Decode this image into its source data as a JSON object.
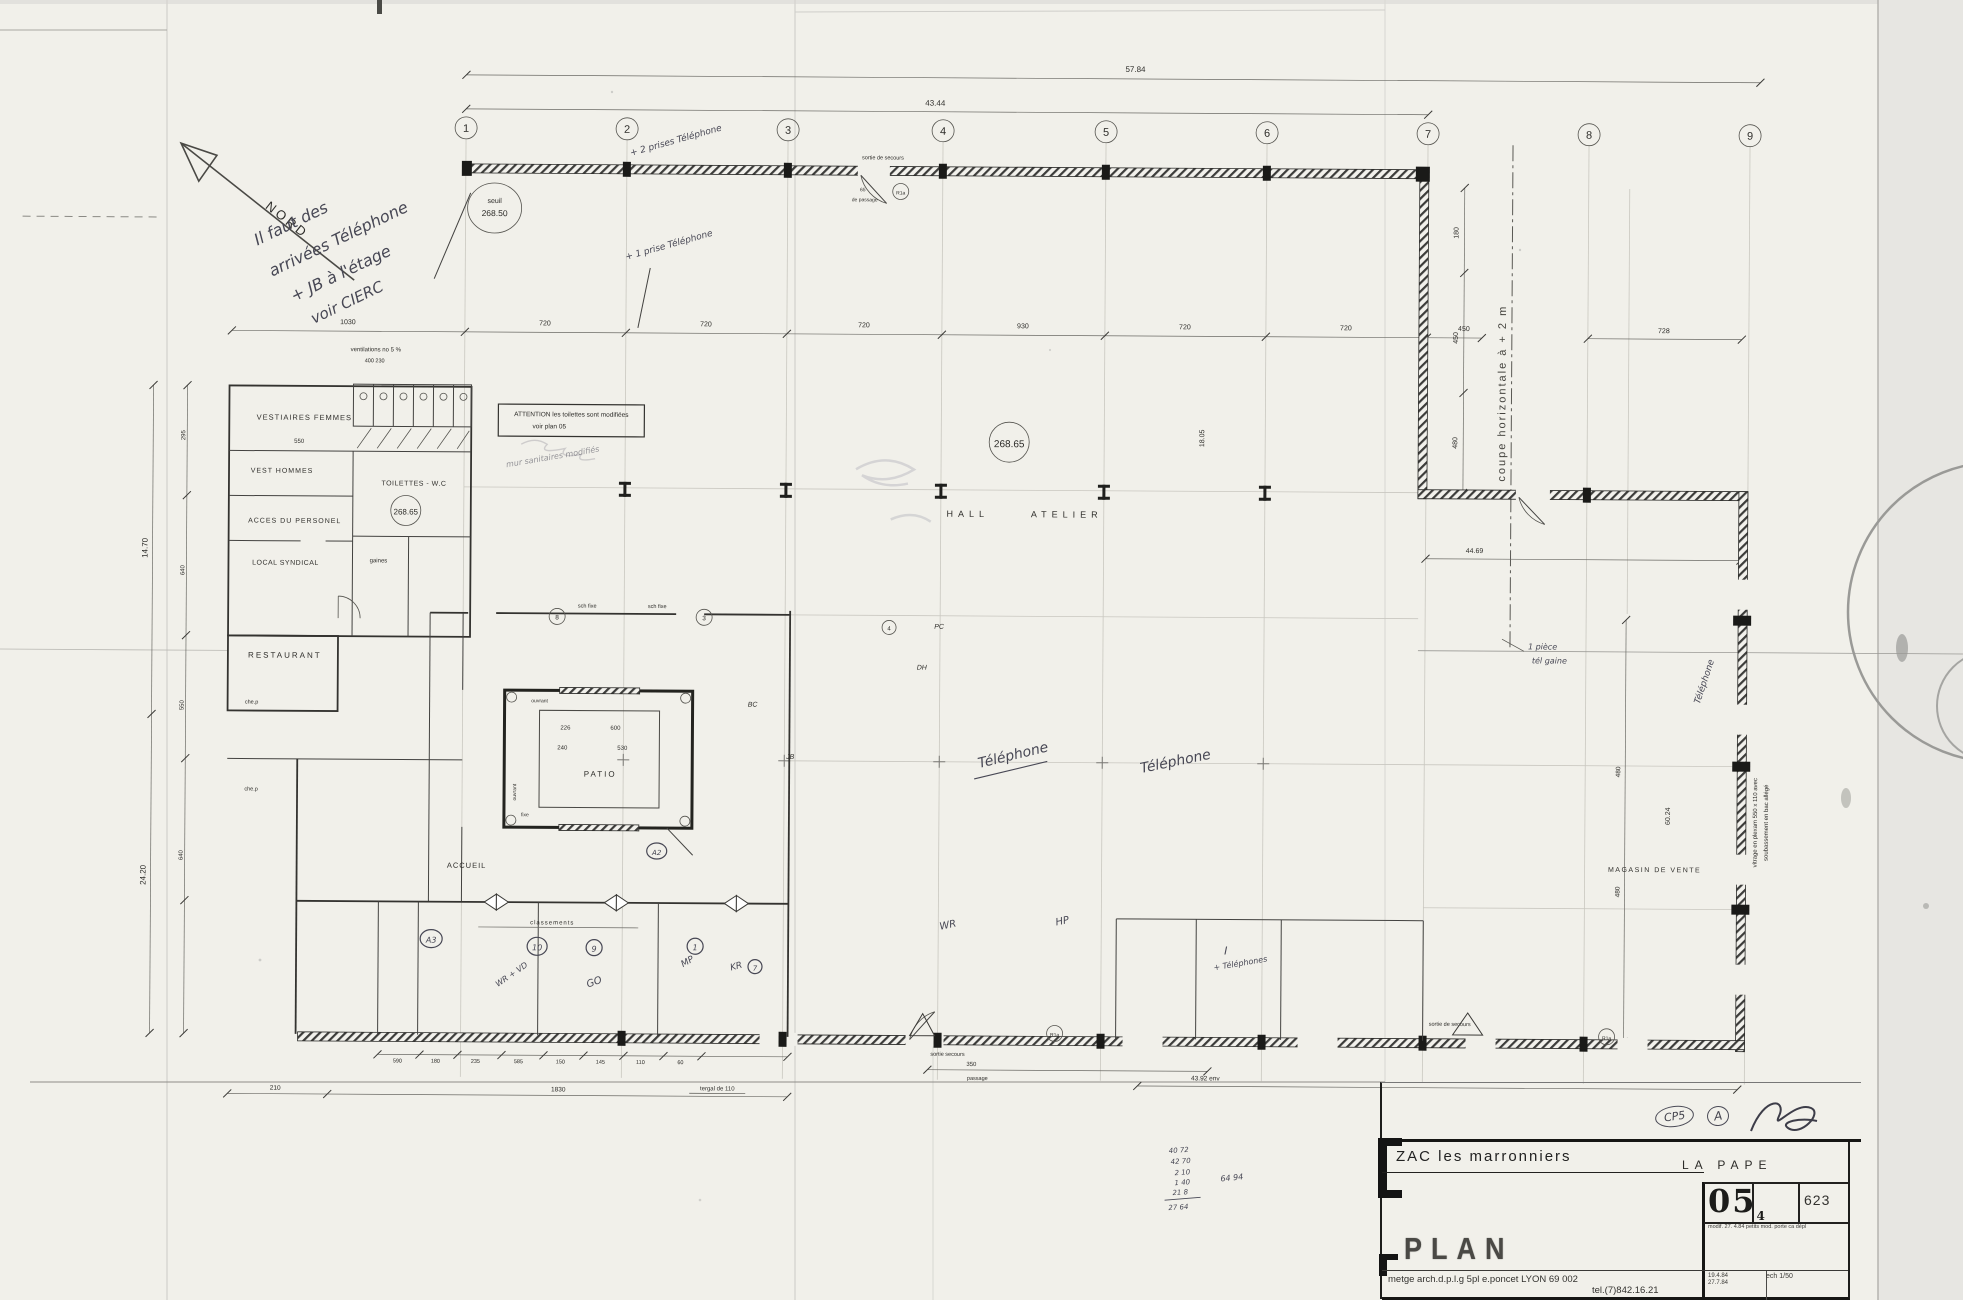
{
  "compass": {
    "label": "NORD"
  },
  "grid": {
    "bubbles": [
      "1",
      "2",
      "3",
      "4",
      "5",
      "6",
      "7",
      "8",
      "9"
    ]
  },
  "levels": {
    "seuil_line1": "seuil",
    "seuil_line2": "268.50",
    "hall": "268.65",
    "wc": "268.65"
  },
  "rooms": {
    "vestiaires": "VESTIAIRES  FEMMES",
    "vest_hommes": "VEST  HOMMES",
    "acces": "ACCES  DU  PERSONEL",
    "toilettes": "TOILETTES - W.C",
    "local_syndical": "LOCAL  SYNDICAL",
    "gaines": "gaines",
    "restaurant": "RESTAURANT",
    "hall_a": "HALL",
    "hall_b": "ATELIER",
    "patio": "PATIO",
    "accueil": "ACCUEIL",
    "magasin": "MAGASIN  DE  VENTE"
  },
  "attention": {
    "line1": "ATTENTION   les toilettes sont modifiées",
    "line2": "voir    plan 05"
  },
  "vent": {
    "line1": "ventilations no 5 %",
    "line2": "400    230"
  },
  "notes": {
    "tl1": "Il faut des",
    "tl2": "arrivées Téléphone",
    "tl3": "+ JB à l'étage",
    "tl4": "voir CIERC",
    "plus2": "+ 2 prises Téléphone",
    "plus1": "+ 1 prise Téléphone",
    "tel_a": "Téléphone",
    "tel_b": "Téléphone",
    "tel_c": "Téléphone",
    "piece": "1 pièce",
    "gaine": "tél gaine",
    "i_label": "I",
    "i_tel": "+ Téléphones",
    "wr": "WR",
    "hp": "HP",
    "scribble": "mur sanitaires modifiés",
    "wrvd": "WR + VD",
    "go": "GO",
    "mp": "MP",
    "kr": "KR"
  },
  "codes": {
    "a3": "A3",
    "n10": "10",
    "n9": "9",
    "n1": "1",
    "n7": "7",
    "a2": "A2",
    "c4": "4",
    "c8": "8",
    "c3": "3",
    "r1a_top": "R1a",
    "r1a_bottom": "R1a",
    "r1a_right": "R1a"
  },
  "marks": {
    "pc": "PC",
    "dh": "DH",
    "jb": "JB",
    "bc": "BC",
    "schfixe1": "sch fixe",
    "schfixe2": "sch fixe",
    "classements": "classements",
    "ouvrant1": "ouvrant",
    "ouvrant2": "ouvrant",
    "fixe": "fixe",
    "chep1": "che.p",
    "chep2": "che.p"
  },
  "sorties": {
    "top": "sortie de secours",
    "top_w": "65",
    "top_p": "de passage",
    "bottom": "sortie  secours",
    "bottom_d": "350",
    "bottom_p": "passage",
    "right": "sortie de secours"
  },
  "coupe": {
    "label": "coupe  horizontale  à  + 2 m"
  },
  "vitrage": {
    "line1": "vitrage en plexam  550 x 110 avec",
    "line2": "soubassement en bac allégé"
  },
  "dims": {
    "top1": "57.84",
    "top2": "43.44",
    "row": [
      "1030",
      "720",
      "720",
      "720",
      "930",
      "720",
      "720",
      "450"
    ],
    "d728": "728",
    "right_col": [
      "180",
      "450",
      "480"
    ],
    "d4469": "44.69",
    "d1805": "18.05",
    "left1": "14.70",
    "left2": "24.20",
    "left_small": [
      "295",
      "640",
      "550",
      "640"
    ],
    "bottom_row": [
      "590",
      "180",
      "235",
      "585",
      "150",
      "145",
      "110",
      "60"
    ],
    "d210": "210",
    "d1830": "1830",
    "d4392": "43.92  env",
    "tergal": "tergal de 110",
    "mag1": "480",
    "mag2": "60.24",
    "mag3": "480",
    "patio": [
      "226",
      "600",
      "240",
      "530"
    ],
    "d550": "550"
  },
  "tally": {
    "rows": [
      "40 72",
      "42 70",
      "2 10",
      "1 40",
      "21 8",
      "27 64"
    ],
    "sum": "64 94"
  },
  "title_block": {
    "project": "ZAC  les  marronniers",
    "location": "LA  PAPE",
    "sheet_no": "05",
    "sheet_sub": "4",
    "sheet_ref": "623",
    "modif_label": "modif.",
    "modif_text": "27. 4.84   petits mod. porte ca dépl",
    "drawing": "PLAN",
    "firm": "metge arch.d.p.l.g  5pl e.poncet  LYON  69 002",
    "phone": "tel.(7)842.16.21",
    "date1": "19.4.84",
    "date2": "27.7.84",
    "scale": "ech  1/50",
    "stamp": "CP5",
    "rev": "A"
  }
}
